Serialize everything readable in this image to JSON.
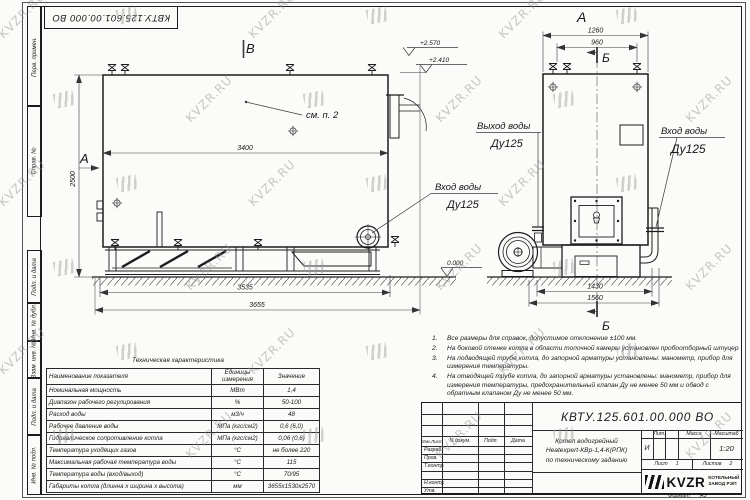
{
  "doc": {
    "number": "КВТУ.125.601.00.000 ВО"
  },
  "margin_stamps": {
    "items": [
      "Перв. примен.",
      "Справ. №",
      "Подп. и дата",
      "Инв. № дубл.",
      "Взам. инв. №",
      "Подп. и дата",
      "Инв. № подл."
    ]
  },
  "views": {
    "left": {
      "section_a": "А",
      "mark_v": "В",
      "see_note": "см. п. 2",
      "dim_inner": "3400",
      "dim_height": "2500",
      "dim_base": "3535",
      "dim_total": "3655",
      "elev_top": "+2.570",
      "elev_mid": "+2.410",
      "elev_zero": "0.000",
      "inlet": "Вход воды",
      "inlet_dn": "Ду125"
    },
    "right": {
      "label_a": "А",
      "section_b": "Б",
      "dim_top1": "1260",
      "dim_top2": "960",
      "dim_bot1": "1430",
      "dim_bot2": "1560",
      "outlet": "Выход воды",
      "outlet_dn": "Ду125",
      "inlet": "Вход воды",
      "inlet_dn": "Ду125"
    }
  },
  "notes": {
    "items": [
      {
        "num": "1.",
        "text": "Все размеры для справок, допустимое отклонение ±100 мм."
      },
      {
        "num": "2.",
        "text": "На боковой стенке котла в области топочной камеры установлен пробоотборный штуцер"
      },
      {
        "num": "3.",
        "text": "На подводящей трубе котла, до запорной арматуры установлены: манометр, прибор для измерения температуры."
      },
      {
        "num": "4.",
        "text": "На отводящей трубе котла, до запорной арматуры установлены: манометр, прибор для измерения температуры, предохранительный клапан Ду не менее 50 мм и обвод с обратным клапаном Ду не менее 50 мм."
      }
    ]
  },
  "spec_table": {
    "title": "Техническая характеристика",
    "headers": [
      "Наименование показателя",
      "Единицы измерения",
      "Значение"
    ],
    "rows": [
      [
        "Номинальная мощность",
        "МВт",
        "1,4"
      ],
      [
        "Диапазон рабочего регулирования",
        "%",
        "50-100"
      ],
      [
        "Расход воды",
        "м3/ч",
        "48"
      ],
      [
        "Рабочее давление воды",
        "МПа (кгс/см2)",
        "0,6 (6,0)"
      ],
      [
        "Гидравлическое сопротивление котла",
        "МПа (кгс/см2)",
        "0,06 (0,6)"
      ],
      [
        "Температура уходящих газов",
        "°С",
        "не более 220"
      ],
      [
        "Максимальная рабочая температура воды",
        "°С",
        "115"
      ],
      [
        "Температура воды (вход/выход)",
        "°С",
        "70/95"
      ],
      [
        "Габариты котла (длинна х ширина х высота)",
        "мм",
        "3655х1530х2570"
      ]
    ]
  },
  "titleblock": {
    "doc_number": "КВТУ.125.601.00.000 ВО",
    "rev_cols": [
      "Изм.Лист",
      "N докум.",
      "Подп.",
      "Дата"
    ],
    "rev_rows": [
      "Разраб.",
      "Пров.",
      "Т.контр.",
      "",
      "Н.контр.",
      "Утв."
    ],
    "name_lines": [
      "Котел водогрейный",
      "Heatexpert-КВр-1,4-К(РПК)",
      "по техническому заданию"
    ],
    "lit_header": "Лит.",
    "lit_value": "И",
    "mass_header": "Масса",
    "scale_header": "Масштаб",
    "scale_value": "1:20",
    "sheet_label": "Лист",
    "sheet_value": "1",
    "sheets_label": "Листов",
    "sheets_value": "2",
    "logo_brand": "KVZR",
    "logo_line1": "КОТЕЛЬНЫЙ",
    "logo_line2": "ЗАВОД РЭП",
    "format_label": "Формат",
    "format_value": "А3"
  },
  "watermark": {
    "text": "KVZR.RU"
  }
}
